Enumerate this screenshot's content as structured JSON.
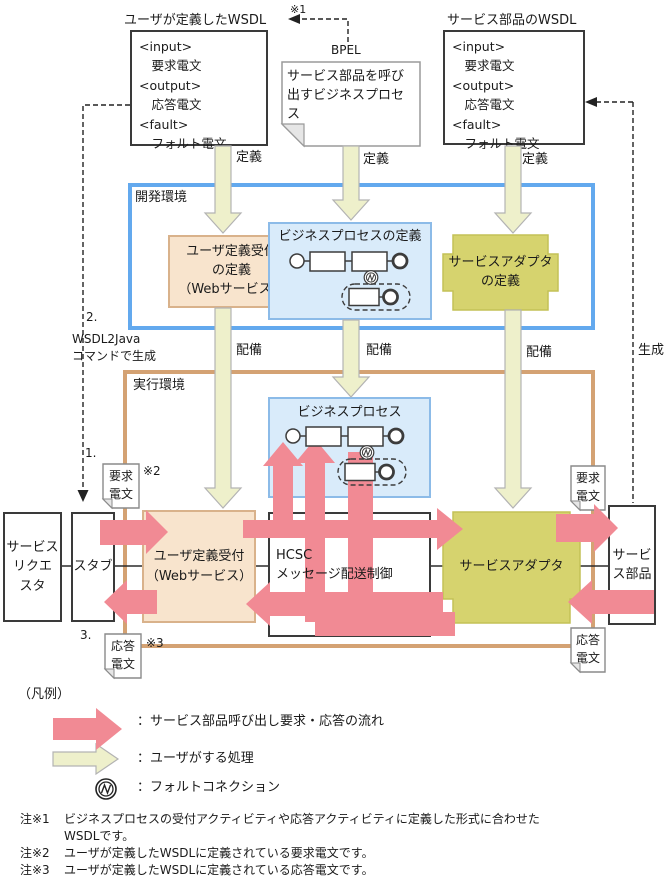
{
  "top": {
    "user_wsdl_title": "ユーザが定義したWSDL",
    "ref1": "※1",
    "bpel": "BPEL",
    "svc_wsdl_title": "サービス部品のWSDL",
    "wsdl_body": "<input>\n　要求電文\n<output>\n　応答電文\n<fault>\n　フォルト電文",
    "bpel_note": "サービス部品を呼び出すビジネスプロセス"
  },
  "arrows": {
    "define": "定義",
    "deploy": "配備",
    "generate": "生成"
  },
  "dev": {
    "label": "開発環境",
    "user_def": "ユーザ定義受付\nの定義\n（Webサービス）",
    "bp_title": "ビジネスプロセスの定義",
    "adapter_def": "サービスアダプタ\nの定義"
  },
  "mid": {
    "step2": "2.",
    "wsdl2java": "WSDL2Java\nコマンドで生成"
  },
  "run": {
    "label": "実行環境",
    "step1": "1.",
    "step3": "3.",
    "ref2": "※2",
    "ref3": "※3",
    "bp_title": "ビジネスプロセス",
    "hcsc": "HCSC\nメッセージ配送制御",
    "requester": "サービス\nリクエ\nスタ",
    "stub": "スタブ",
    "user_def": "ユーザ定義受付\n（Webサービス）",
    "adapter": "サービスアダプタ",
    "component": "サービ\nス部品",
    "req_flag": "要求\n電文",
    "res_flag": "応答\n電文"
  },
  "legend": {
    "title": "（凡例）",
    "pink": "：サービス部品呼び出し要求・応答の流れ",
    "green": "：ユーザがする処理",
    "fault": "：フォルトコネクション"
  },
  "footnotes": [
    {
      "label": "注※1",
      "text": "ビジネスプロセスの受付アクティビティや応答アクティビティに定義した形式に合わせた\nWSDLです。"
    },
    {
      "label": "注※2",
      "text": "ユーザが定義したWSDLに定義されている要求電文です。"
    },
    {
      "label": "注※3",
      "text": "ユーザが定義したWSDLに定義されている応答電文です。"
    }
  ],
  "colors": {
    "pink": "#f18a94",
    "green_fill": "#eef0cb",
    "peach": "#f8e4cd",
    "blue_fill": "#d9ebfa",
    "olive": "#d6d36e",
    "dev_border": "#63a9ee",
    "run_border": "#d4a273"
  }
}
